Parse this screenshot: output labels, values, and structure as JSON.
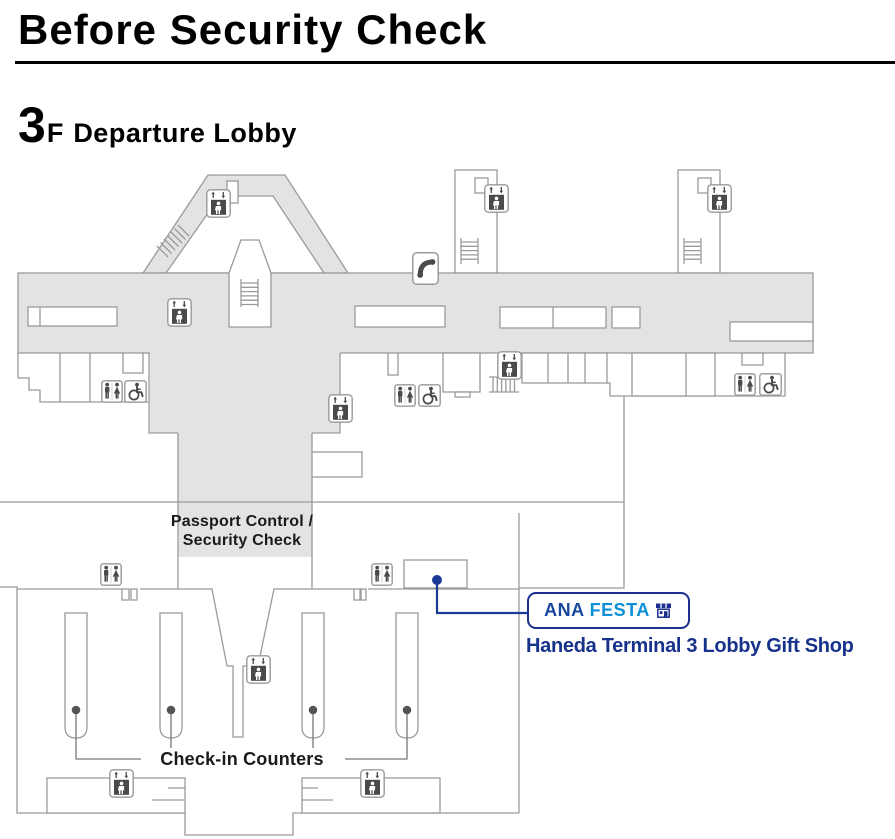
{
  "header": {
    "title": "Before Security Check",
    "floor": {
      "number": "3",
      "suffix": "F",
      "name": "Departure Lobby"
    }
  },
  "map": {
    "labels": {
      "passport_line1": "Passport Control /",
      "passport_line2": "Security Check",
      "checkin": "Check-in Counters"
    },
    "gift_shop": {
      "logo_ana": "ANA",
      "logo_festa": "FESTA",
      "store_icon": "storefront-icon",
      "caption": "Haneda Terminal 3 Lobby Gift Shop"
    },
    "colors": {
      "floor_fill": "#e3e3e3",
      "outline": "#9a9a9a",
      "icon_dark": "#4a4a4a",
      "marker_blue": "#1b3a97",
      "brand_dark_blue": "#1b2f8e",
      "brand_ana_blue": "#17469c",
      "brand_festa_blue": "#0c8fd9",
      "caption_blue": "#16328b"
    },
    "icons": [
      {
        "type": "elevator",
        "x": 206,
        "y": 189
      },
      {
        "type": "elevator",
        "x": 484,
        "y": 184
      },
      {
        "type": "elevator",
        "x": 707,
        "y": 184
      },
      {
        "type": "elevator",
        "x": 167,
        "y": 298
      },
      {
        "type": "elevator",
        "x": 497,
        "y": 351
      },
      {
        "type": "elevator",
        "x": 328,
        "y": 394
      },
      {
        "type": "elevator",
        "x": 246,
        "y": 655
      },
      {
        "type": "elevator",
        "x": 109,
        "y": 769
      },
      {
        "type": "elevator",
        "x": 360,
        "y": 769
      },
      {
        "type": "restroom",
        "x": 101,
        "y": 380
      },
      {
        "type": "restroom",
        "x": 394,
        "y": 384
      },
      {
        "type": "restroom",
        "x": 734,
        "y": 373
      },
      {
        "type": "restroom",
        "x": 100,
        "y": 563
      },
      {
        "type": "restroom",
        "x": 371,
        "y": 563
      },
      {
        "type": "wheelchair",
        "x": 124,
        "y": 380
      },
      {
        "type": "wheelchair",
        "x": 418,
        "y": 384
      },
      {
        "type": "wheelchair",
        "x": 759,
        "y": 373
      },
      {
        "type": "phone",
        "x": 412,
        "y": 252
      }
    ]
  }
}
